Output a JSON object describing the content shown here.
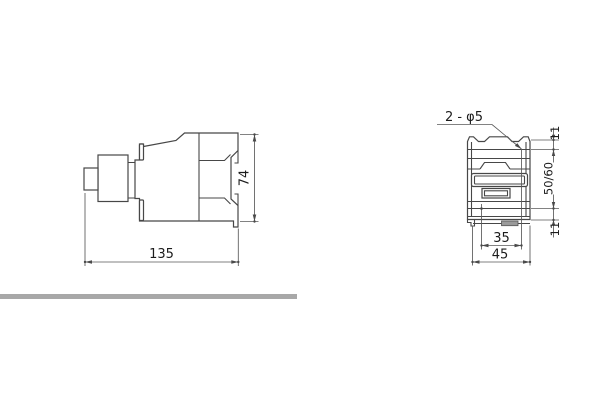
{
  "page": {
    "background": "#ffffff"
  },
  "separator": {
    "color": "#a8a8a8"
  },
  "colors": {
    "outline": "#474747",
    "dimension": "#5a5a5a",
    "text": "#1c1c1c",
    "tab_fill": "#9a9a9a"
  },
  "side_view": {
    "title": "contactor side view",
    "width_label": "135",
    "height_label": "74"
  },
  "front_view": {
    "title": "contactor front / mounting view",
    "hole_callout": "2 - φ5",
    "top_offset_label": "11",
    "vertical_spacing_label": "50/60",
    "bottom_offset_label": "11",
    "hole_spacing_label": "35",
    "width_label": "45"
  }
}
